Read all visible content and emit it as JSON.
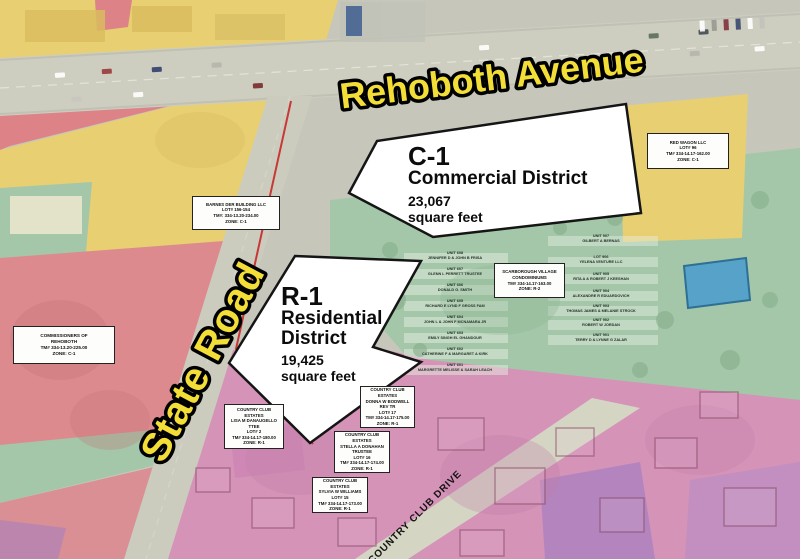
{
  "streets": {
    "rehoboth_avenue": "Rehoboth Avenue",
    "state_road": "State Road",
    "country_club_drive": "COUNTRY CLUB DRIVE"
  },
  "districts": {
    "c1": {
      "code": "C-1",
      "name": "Commercial District",
      "area": "23,067",
      "unit": "square feet"
    },
    "r1": {
      "code": "R-1",
      "name_line1": "Residential",
      "name_line2": "District",
      "area": "19,425",
      "unit": "square feet"
    }
  },
  "parcel_boxes": {
    "barnes": "BARNES DER BUILDING LLC\nLOT# 156-154\nTM#: 334-13.20-234.00\nZONE: C-1",
    "red_wagon": "RED WAGON LLC\nLOT# 96\nTM# 334-14.17-162.00\nZONE: C-1",
    "commissioners": "COMMISSIONERS OF\nREHOBOTH\nTM# 334-13.20-225.00\nZONE: C-1",
    "scarborough": "SCARBOROUGH VILLAGE\nCONDOMINIUMS\nTM# 334-14.17-163.00\nZONE: R-2",
    "cc_lot2": "COUNTRY CLUB\nESTATES\nLISA M DANAUGELLO\nTTEE\nLOT# 2\nTM# 334-14.17-180.00\nZONE: R-1",
    "cc_lot17": "COUNTRY CLUB\nESTATES\nDONNA W BODWELL\nREV TR\nLOT# 17\nTM# 334-14.17-175.00\nZONE: R-1",
    "cc_lot16": "COUNTRY CLUB\nESTATES\nSTELLA A DONAHAN\nTRUSTEE\nLOT# 16\nTM# 334-14.17-174.00\nZONE: R-1",
    "cc_lot15": "COUNTRY CLUB\nESTATES\nSYLVIA W WILLIAMS\nLOT# 15\nTM# 334-14.17-173.00\nZONE: R-1"
  },
  "condo_units": {
    "left": [
      "UNIT 608\nJENNIFER D & JOHN B FRISA",
      "UNIT 607\nGLENN L PERRETT TRUSTEE",
      "UNIT 606\nDONALD G. SMITH",
      "UNIT 605\nRICHARD E LYND F GROSS FAM",
      "UNIT 604\nJOHN L & JOHN F MCNAMARA JR",
      "UNIT 603\nEMILY SINGH EL GHANDOUR",
      "UNIT 602\nCATHERINE F & MARGARET A KIRK",
      "UNIT 601\nMARGRETTE MELISSE & SARAH LEACH"
    ],
    "right": [
      "UNIT 907\nGILBERT A BERNAS",
      "LOT 906\nYELENA VENTURE LLC",
      "UNIT 905\nRITA A & ROBERT J KEESHAN",
      "UNIT 904\nALEXANDRE R EDUARDOVICH",
      "UNIT 903\nTHOMAS JAMES & MELANIE STROCK",
      "UNIT 902\nROBERT W JORDAN",
      "UNIT 901\nTERRY D & LYNNE G ZALAR"
    ]
  },
  "colors": {
    "street_label_yellow": "#f2de37",
    "outline_black": "#000000",
    "commercial_yellow": "#e8cf72",
    "left_red": "#dd8a8e",
    "condo_green": "#a3c7a8",
    "estates_pink": "#d593b8",
    "road_gray": "#cdcdc0",
    "parcel_white": "#ffffff",
    "pool_blue": "#57a2c9",
    "boundary_red": "#c62828"
  }
}
